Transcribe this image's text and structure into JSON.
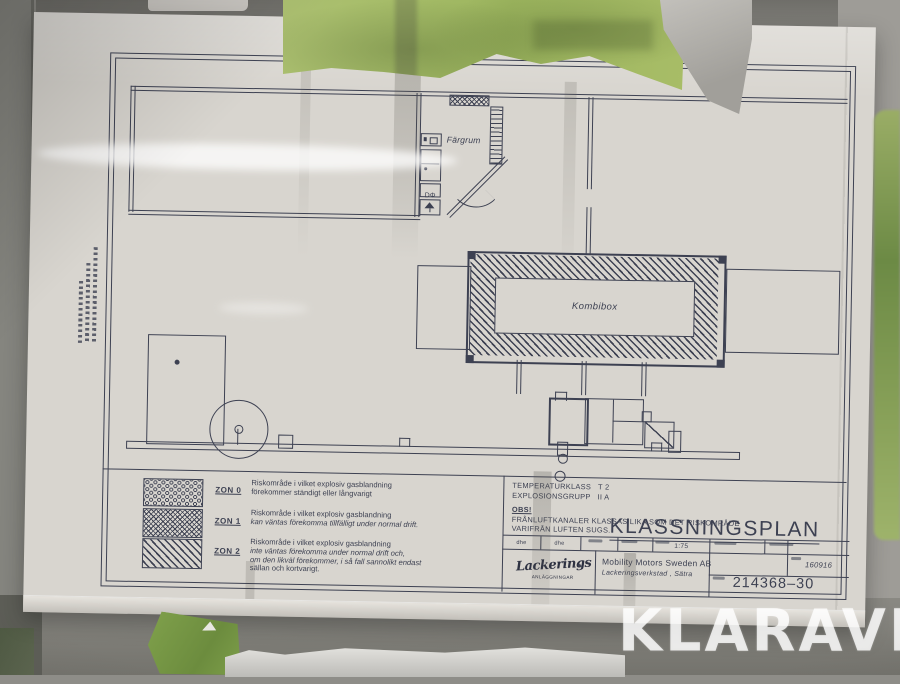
{
  "watermark": {
    "text": "KLARAVIK"
  },
  "plan": {
    "labels": {
      "fargrum": "Färgrum",
      "kombibox": "Kombibox"
    },
    "symbols": {
      "valve": "DΦ"
    }
  },
  "legend": {
    "zones": [
      {
        "id": "ZON 0",
        "lines": [
          "Riskområde i vilket explosiv gasblandning",
          "förekommer ständigt eller långvarigt"
        ]
      },
      {
        "id": "ZON 1",
        "lines": [
          "Riskområde i vilket explosiv gasblandning",
          "kan väntas förekomma tillfälligt under normal drift."
        ]
      },
      {
        "id": "ZON 2",
        "lines": [
          "Riskområde i vilket explosiv gasblandning",
          "inte väntas förekomma under normal drift och,",
          "om den likväl förekommer, i så fall sannolikt endast",
          "sällan och kortvarigt."
        ]
      }
    ]
  },
  "title_block": {
    "temperature_class": "TEMPERATURKLASS   T 2",
    "explosion_group": "EXPLOSIONSGRUPP   II A",
    "obs": "OBS!",
    "note_line1": "FRÅNLUFTKANALER KLASSAS LIKA SOM DET RISKOMRÅDE",
    "note_line2": "VARIFRÅN LUFTEN SUGS.",
    "title": "KLASSNINGSPLAN",
    "sign1": "dhe",
    "sign2": "dhe",
    "scale": "1:75",
    "logo_script": "Lackerings",
    "logo_sub": "ANLÄGGNINGAR",
    "company": "Mobility Motors Sweden AB",
    "company_sub": "Lackeringsverkstad , Sätra",
    "date": "160916",
    "drawing_number": "214368–30"
  },
  "colors": {
    "line": "#3d4152",
    "paper": "#d8d5cf",
    "tape_green": "#a6bd68"
  }
}
